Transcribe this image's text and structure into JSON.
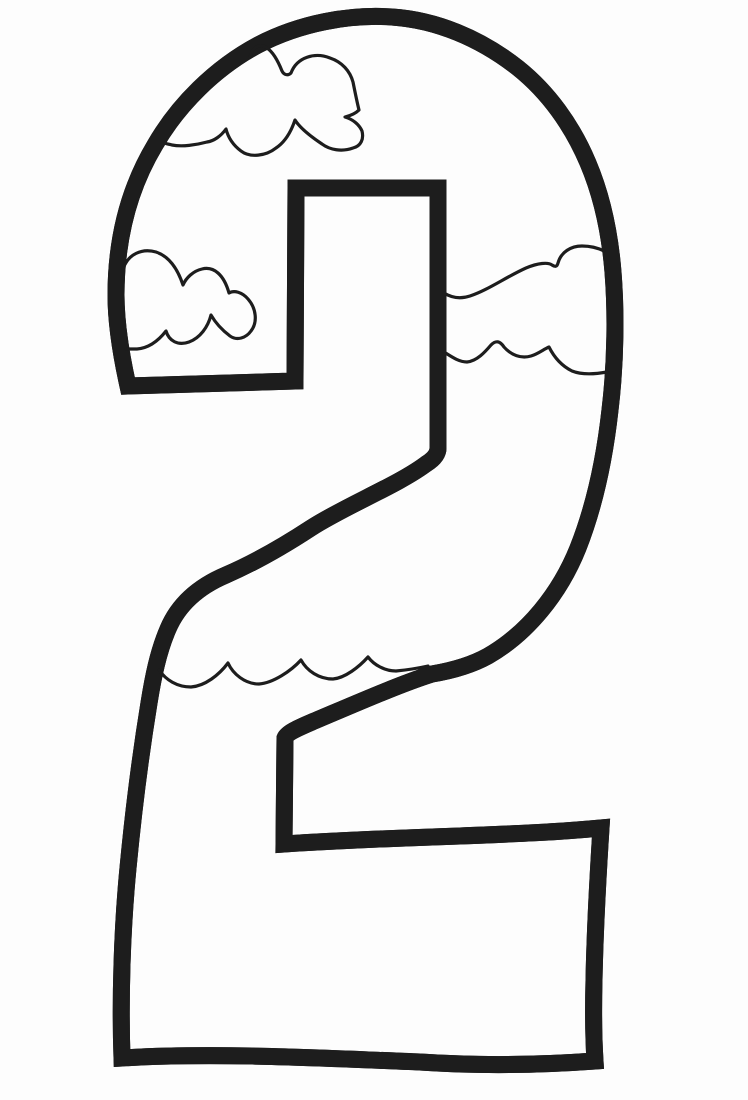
{
  "artwork": {
    "figure_value": "2",
    "description": "Coloring page line art of a large outlined number 2 decorated inside with three puffy cartoon clouds and a scalloped cloud-base wave line, black outlines on white paper",
    "line_color": "#1d1d1d",
    "paper_color": "#fdfdfd",
    "elements": {
      "glyph": "number-2-double-outline",
      "cloud_top": "puffy-cloud-attached-to-upper-left-inner-edge",
      "cloud_left": "m-shaped-cloud-attached-to-left-inner-edge",
      "cloud_right": "cloud-band-between-counter-edge-and-right-inner-edge",
      "wave": "scalloped-cloud-base-line-across-diagonal-stroke"
    }
  }
}
